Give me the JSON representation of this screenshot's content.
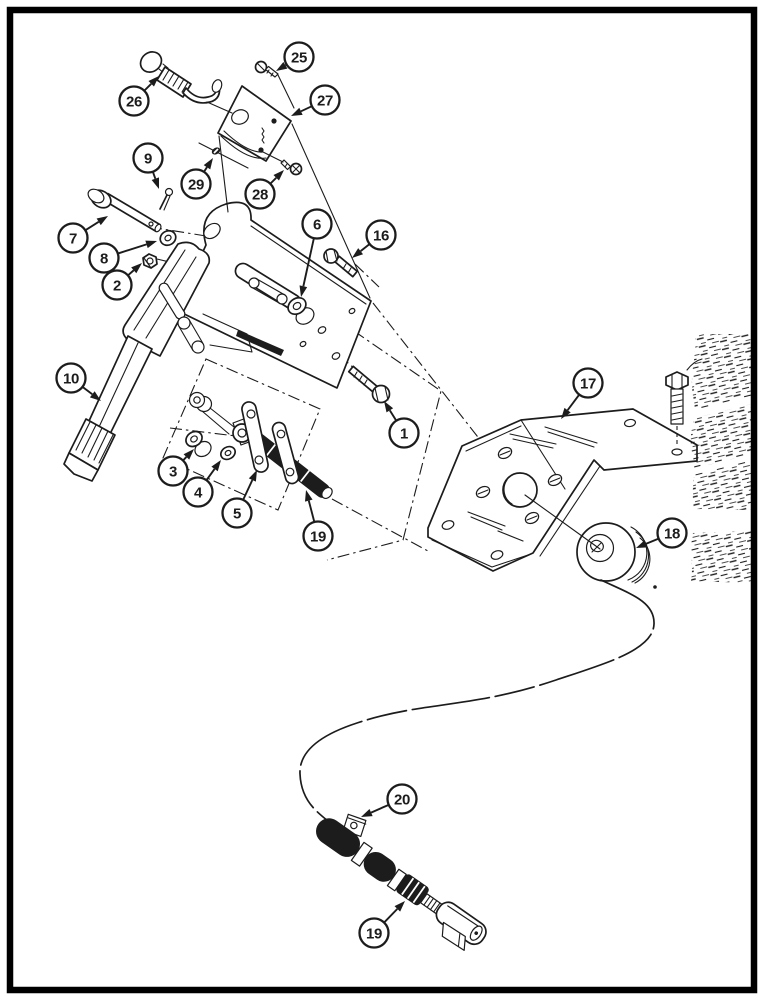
{
  "document": {
    "kind": "exploded-parts-diagram",
    "page_background": "#ffffff"
  },
  "colors": {
    "ink": "#1c1c1c",
    "paper": "#ffffff"
  },
  "callouts": [
    {
      "label": "25",
      "cx": 299,
      "cy": 57,
      "tx": 276,
      "ty": 71
    },
    {
      "label": "26",
      "cx": 134,
      "cy": 101,
      "tx": 159,
      "ty": 76
    },
    {
      "label": "27",
      "cx": 325,
      "cy": 100,
      "tx": 291,
      "ty": 116
    },
    {
      "label": "29",
      "cx": 196,
      "cy": 184,
      "tx": 213,
      "ty": 158
    },
    {
      "label": "28",
      "cx": 260,
      "cy": 194,
      "tx": 284,
      "ty": 170
    },
    {
      "label": "9",
      "cx": 148,
      "cy": 158,
      "tx": 159,
      "ty": 189
    },
    {
      "label": "7",
      "cx": 73,
      "cy": 238,
      "tx": 108,
      "ty": 216
    },
    {
      "label": "8",
      "cx": 104,
      "cy": 258,
      "tx": 157,
      "ty": 241
    },
    {
      "label": "2",
      "cx": 117,
      "cy": 285,
      "tx": 142,
      "ty": 263
    },
    {
      "label": "6",
      "cx": 317,
      "cy": 224,
      "tx": 301,
      "ty": 297
    },
    {
      "label": "16",
      "cx": 381,
      "cy": 235,
      "tx": 352,
      "ty": 258
    },
    {
      "label": "10",
      "cx": 71,
      "cy": 378,
      "tx": 101,
      "ty": 401
    },
    {
      "label": "1",
      "cx": 404,
      "cy": 433,
      "tx": 384,
      "ty": 401
    },
    {
      "label": "3",
      "cx": 173,
      "cy": 471,
      "tx": 194,
      "ty": 449
    },
    {
      "label": "4",
      "cx": 198,
      "cy": 492,
      "tx": 221,
      "ty": 460
    },
    {
      "label": "5",
      "cx": 237,
      "cy": 513,
      "tx": 257,
      "ty": 470
    },
    {
      "label": "19",
      "cx": 318,
      "cy": 536,
      "tx": 306,
      "ty": 490
    },
    {
      "label": "17",
      "cx": 588,
      "cy": 383,
      "tx": 561,
      "ty": 419
    },
    {
      "label": "18",
      "cx": 672,
      "cy": 533,
      "tx": 636,
      "ty": 548
    },
    {
      "label": "20",
      "cx": 402,
      "cy": 799,
      "tx": 361,
      "ty": 817
    },
    {
      "label": "19",
      "cx": 374,
      "cy": 933,
      "tx": 405,
      "ty": 901
    }
  ],
  "callout_style": {
    "radius": 14.5
  }
}
